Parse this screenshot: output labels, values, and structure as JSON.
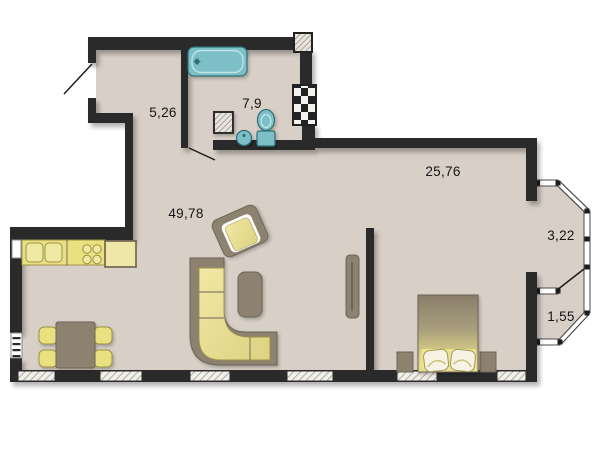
{
  "plan": {
    "rooms": [
      {
        "key": "hallway",
        "area": "5,26"
      },
      {
        "key": "bathroom",
        "area": "7,9"
      },
      {
        "key": "bedroom",
        "area": "25,76"
      },
      {
        "key": "living-kitchen",
        "area": "49,78"
      },
      {
        "key": "balcony-top",
        "area": "3,22"
      },
      {
        "key": "balcony-bottom",
        "area": "1,55"
      }
    ],
    "colors": {
      "wall": "#2b2b2b",
      "floor": "#d8d0c7",
      "outside": "#ffffff",
      "fixture": "#7bbfc7",
      "fixture-edge": "#2f6f78",
      "yellow": "#e9e07f",
      "yellow-light": "#f0e9a4",
      "yellow-edge": "#9c9246",
      "brown": "#8d8170",
      "brown-edge": "#6e6457",
      "label": "#141414"
    },
    "symbols": [
      {
        "name": "bathtub",
        "count": 1
      },
      {
        "name": "washbasin",
        "count": 1
      },
      {
        "name": "toilet",
        "count": 1
      },
      {
        "name": "sink-unit",
        "count": 1
      },
      {
        "name": "ventilation-shaft",
        "count": 1
      },
      {
        "name": "structural-column",
        "count": 1
      },
      {
        "name": "kitchen-counter",
        "count": 1
      },
      {
        "name": "kitchen-sink-bowl",
        "count": 2
      },
      {
        "name": "stove-burner",
        "count": 4
      },
      {
        "name": "fridge",
        "count": 1
      },
      {
        "name": "dining-table",
        "count": 1
      },
      {
        "name": "chair",
        "count": 4
      },
      {
        "name": "corner-sofa",
        "count": 1
      },
      {
        "name": "ottoman",
        "count": 1
      },
      {
        "name": "armchair",
        "count": 1
      },
      {
        "name": "tv-stand",
        "count": 1
      },
      {
        "name": "double-bed",
        "count": 1
      },
      {
        "name": "pillow",
        "count": 2
      },
      {
        "name": "nightstand",
        "count": 2
      },
      {
        "name": "window-segment",
        "count": 7
      },
      {
        "name": "door-swing",
        "count": 3
      },
      {
        "name": "radiator",
        "count": 1
      }
    ]
  }
}
